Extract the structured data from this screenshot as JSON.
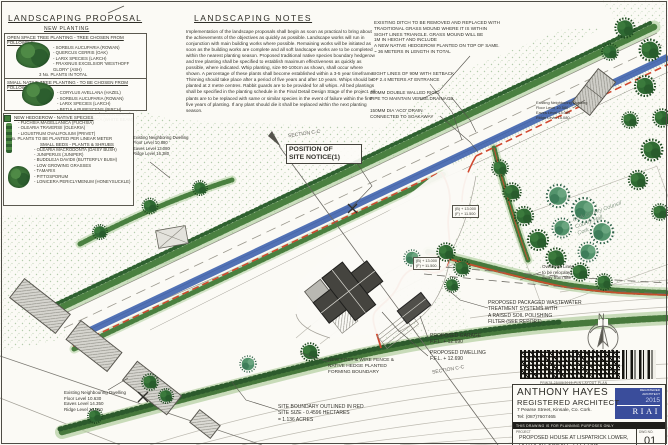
{
  "colors": {
    "paper": "#fbfaf5",
    "hedge_green": "#4a8040",
    "road_blue": "#3f63ae",
    "boundary_red": "#c6502e",
    "building_dark": "#45443f",
    "badge_blue": "#3a4d9b"
  },
  "proposal_panel": {
    "title": "LANDSCAPING  PROPOSAL",
    "subtitle": "NEW PLANTING",
    "open_space": {
      "heading": "OPEN SPACE TREE PLANTING - TREE CHOSEN FROM FOLLOWING:",
      "items": [
        "- SORBUS AUCUPARIA (ROWAN)",
        "- QUERCUS CERRIS (OAK)",
        "- LARIX SPECIES (LARCH)",
        "- FRAXINUS EXCELSIOR 'WESTHOFF GLORY' (ASH)"
      ],
      "total": "3 No.  PLANTS IN TOTAL"
    },
    "small_native": {
      "heading": "SMALL NATIVE TREE PLANTING - TO BE CHOSEN FROM FOLLOWING:-",
      "items": [
        "- CORYLUS AVELLANA (HAZEL)",
        "- SORBUS AUCUPARIA (ROWAN)",
        "- LARIX SPECIES (LARCH)",
        "- BETULA PUBESCENS (BIRCH)",
        "- BETULA PENDULA (SILVER BIRCH)",
        "- SORBUS HIBERNICA (WHITE BEAM)"
      ],
      "total": "12 No.  PLANTS IN TOTAL"
    },
    "hedgerow": {
      "heading": "NEW HEDGEROW - NATIVE SPECIES",
      "items": [
        "- FUCHSIA MAGELLANICA (FUCHSIA)",
        "- OLEARIA TRAVERSII (OLEARIA)",
        "- LIGUSTRUM OVALIFOLIUM (PRIVET)"
      ],
      "total": "2 No. PLANTS TO BE PLANTED PER LINEAR METER"
    },
    "small_beds": {
      "heading": "SMALL BEDS  -  PLANTS & SHRUBS",
      "items": [
        "- OLEARIA MACRODONTA (DAISY BUSH)",
        "- JUNIPERUS (JUNIPER)",
        "- BUDDLEJA DAVIDII (BUTTERFLY BUSH)",
        "- LOW GROWING GRASSES",
        "- TAMARIX",
        "- PITTOSPORUM",
        "- LONICERA PERICLYMENUM (HONEYSUCKLE)"
      ]
    }
  },
  "notes_panel": {
    "title": "LANDSCAPING  NOTES",
    "body": "Implementation of the landscape proposals shall begin as soon as practical to bring about the achievements of the objectives as quickly as possible. Landscape works will run in conjunction with main building works where possible. Remaining works will be initiated as soon as the building works are complete and all soft landscape works are to be completed within the nearest planting season. Proposed traditional native species boundary hedgerow and tree planting shall be specified to establish maximum effectiveness as quickly as possible, where indicated. Whip planting, size 90-100cm as shown, shall occur where shown. A percentage of these plants shall become established within a 3-5 year timeframe. Thinning should take place after a period of five years and after 10 years. Whips should be planted at 2 metre centres. Rabbit guards are to be provided for all whips. All bed plantings shall be specified in the planting schedule in the Final Detail Design Stage of the project. All plants are to be replaced with same or similar species in the event of failure within the first five years of planting. If any plant should die it shall be replaced within the next planting season."
  },
  "site_notes": {
    "ditch": "EXISTING DITCH TO BE  REMOVED AND REPLACED WITH\nTRADITIONAL GRASS MOUND WHERE  IT IS WITHIN\nSIGHT LINES TRIANGLE.  GRASS MOUND WILL BE\n1M IN HEIGHT AND INCLUDE\nA NEW  NATIVE HEDGEROW  PLANTED ON TOP OF SAME.\n~ 36  METERS  IN LENGTH IN  TOTAL",
    "sight_lines": "SIGHT LINES OF 90M WITH SETBACK\nOF 2.4 METERS AT ENTRANCE",
    "pipe": "300MM DOUBLE WALLED  RIGID\nPIPE TO MAINTAIN VERGE DRAINAGE",
    "aco": "150MM DIA 'ACO' DRAIN\nCONNECTED TO  SOAKAWAY"
  },
  "plan_labels": {
    "section_top": "SECTION C-C",
    "site_notice": "POSITION OF\nSITE NOTICE(1)",
    "overhead": "Overhead Lines\nto be  relocated\naway from site",
    "wastewater": "PROPOSED PACKAGED WASTEWATER\nTREATMENT SYSTEMS WITH\nA RAISED SOIL POLISHING\nFILTER (SEE REPORT)",
    "garage": "PROPOSED GARAGE\nF.F.L. + 12.690",
    "dwelling": "PROPOSED DWELLING\nF.F.L. + 12.690",
    "section_bottom": "SECTION C-C",
    "fence": "NEW  POST & WIRE FENCE &\nNATIVE HEDGE PLANTED\nFORMING BOUNDARY",
    "boundary": "SITE BOUNDARY OUTLINED  IN RED\nSITE SIZE - 0.4596 HECTARES\n=  1.136 ACRES"
  },
  "dwellings": {
    "left": "Existing Neighboring Dwelling\nFloor Level  10.680\nEaves Level  13.080\nRidge Level  16.380",
    "bottom": "Existing Neighbouring Dwelling\nFloor Level  10.630\nEaves Level  14.350\nRidge Level  16.910",
    "right": "Existing Neighboring Dwelling\nFloor Level  10.580\nEaves Level  13.080\nRidge Level  15.080"
  },
  "levels_box": "(B) + 13.000\n(F) + 11.500",
  "stamp": "Cork County Council\nCounty Hall\nCork",
  "compass": {
    "n": "N"
  },
  "barcode_caption": "PRW78-25/05/2015-PLN  LAYOUT  PLAN",
  "title_block": {
    "name": "ANTHONY HAYES",
    "role": "REGISTERED ARCHITECT",
    "address": "7 Pearse Street, Kinsale, Co. Cork.",
    "tel": "Tel: (087)7607465",
    "planning_note": "THIS DRAWING IS FOR PLANNING PURPOSES ONLY",
    "project_label": "PROJECT",
    "project_line1": "PROPOSED  HOUSE  AT LISPATRICK LOWER,",
    "project_line2": "OLD HEAD, KINSALE, CO. CORK.",
    "dwg_label": "DWG  NO.",
    "dwg_no": "01",
    "badge_reg": "REGISTERED\nARCHITECT",
    "badge_year": "2015",
    "badge_org": "RIAI"
  }
}
